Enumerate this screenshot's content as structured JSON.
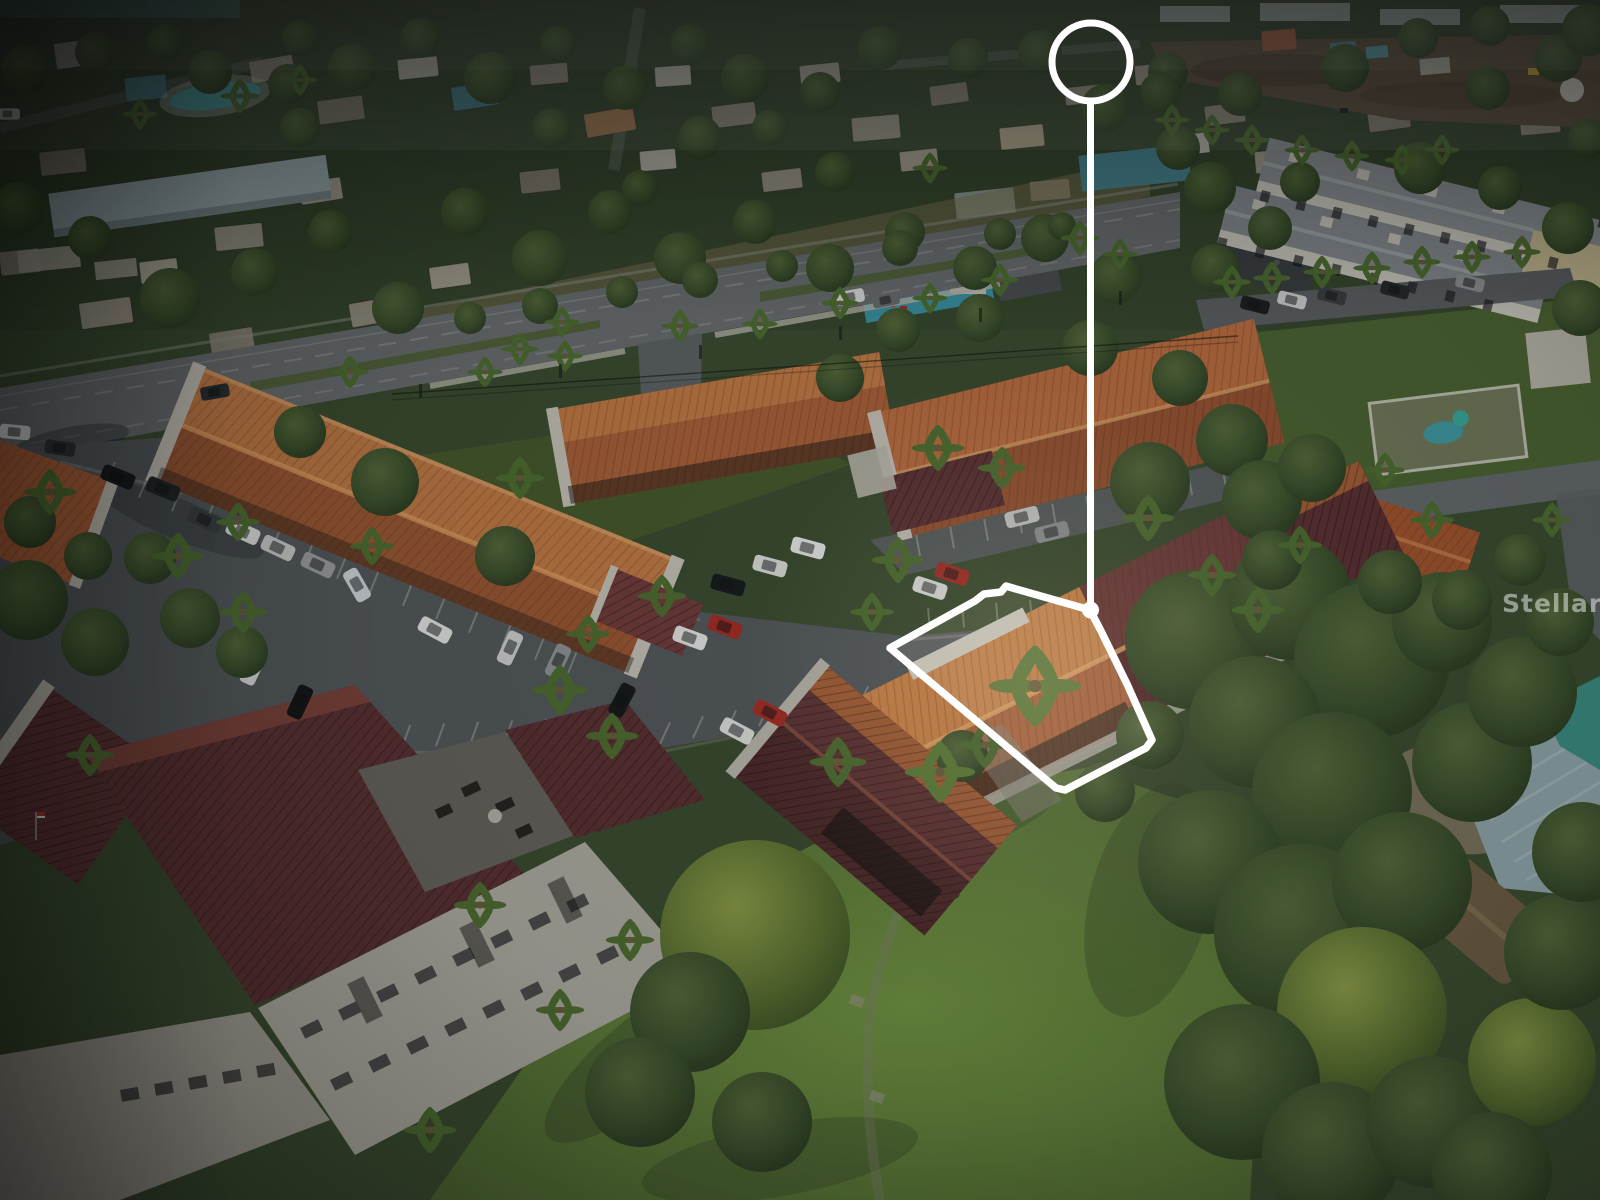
{
  "meta": {
    "type": "aerial-real-estate-photo",
    "description": "Dusk aerial drone photo of a Florida condo community; subject condo unit traced with a white outline connected by a vertical stem to a white circle locator at top"
  },
  "watermark": {
    "text": "Stellar MLS",
    "color_rgba": "rgba(255,255,255,0.48)"
  },
  "annotations": {
    "marker": {
      "shape": "circle-with-stem",
      "color": "#ffffff"
    },
    "outline": {
      "shape": "property-boundary-polygon",
      "color": "#ffffff"
    }
  },
  "palette": {
    "canopy": "#3e5128",
    "canopy_light": "#5c7036",
    "lawn_lit": "#719140",
    "lawn": "#4e6630",
    "asphalt": "#54575b",
    "highway": "#696c6e",
    "roof_orange_lit": "#c27a45",
    "roof_orange": "#a85f38",
    "roof_orange_subject": "#d08347",
    "roof_maroon": "#5a2f31",
    "roof_maroon_lit": "#6f3b3a",
    "wall_white": "#b9b4a9",
    "wall_bright": "#c4bfb4",
    "roof_teal": "#4f8691",
    "metal_roof": "#8fa3a8",
    "dirt": "#5e4d3a",
    "sand": "#857763"
  }
}
